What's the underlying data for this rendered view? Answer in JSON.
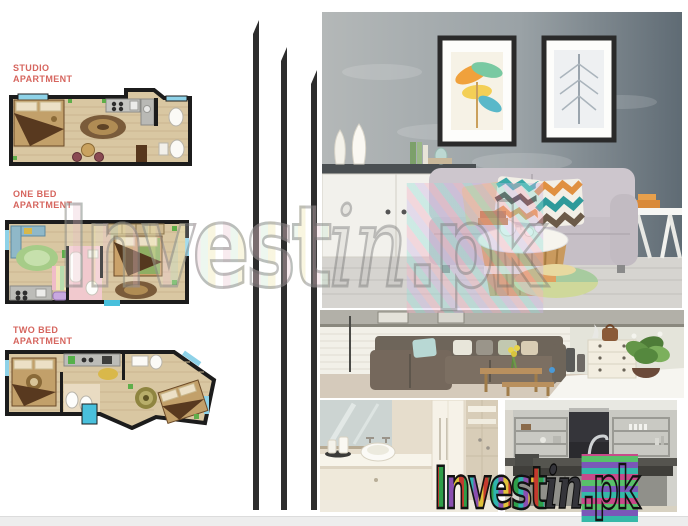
{
  "canvas": {
    "background": "#ffffff",
    "bottom_bar_color": "#ededed"
  },
  "floorplans": {
    "label_color": "#d6655e",
    "floor_color": "#d9c7a2",
    "wall_color": "#1c1c1c",
    "window_color": "#8ed2e8",
    "items": [
      {
        "id": "studio",
        "label_line1": "STUDIO",
        "label_line2": "APARTMENT"
      },
      {
        "id": "one-bed",
        "label_line1": "ONE BED",
        "label_line2": "APARTMENT"
      },
      {
        "id": "two-bed",
        "label_line1": "TWO BED",
        "label_line2": "APARTMENT"
      }
    ]
  },
  "dividers": {
    "count": 3,
    "color": "#2d2d2d"
  },
  "photos": {
    "top": "living-room-gray-wall-sofa-photo",
    "middle": "living-room-sectional-sofa-photo",
    "bottom_left": "bathroom-vanity-photo",
    "bottom_right": "kitchen-island-photo"
  },
  "watermark": {
    "brand": "Investin.pk",
    "center": {
      "part1": "Invest",
      "part2": "in",
      "part3": ".pk"
    },
    "bottom": {
      "part1": "Invest",
      "part2": "in",
      "part3": ".pk"
    }
  }
}
